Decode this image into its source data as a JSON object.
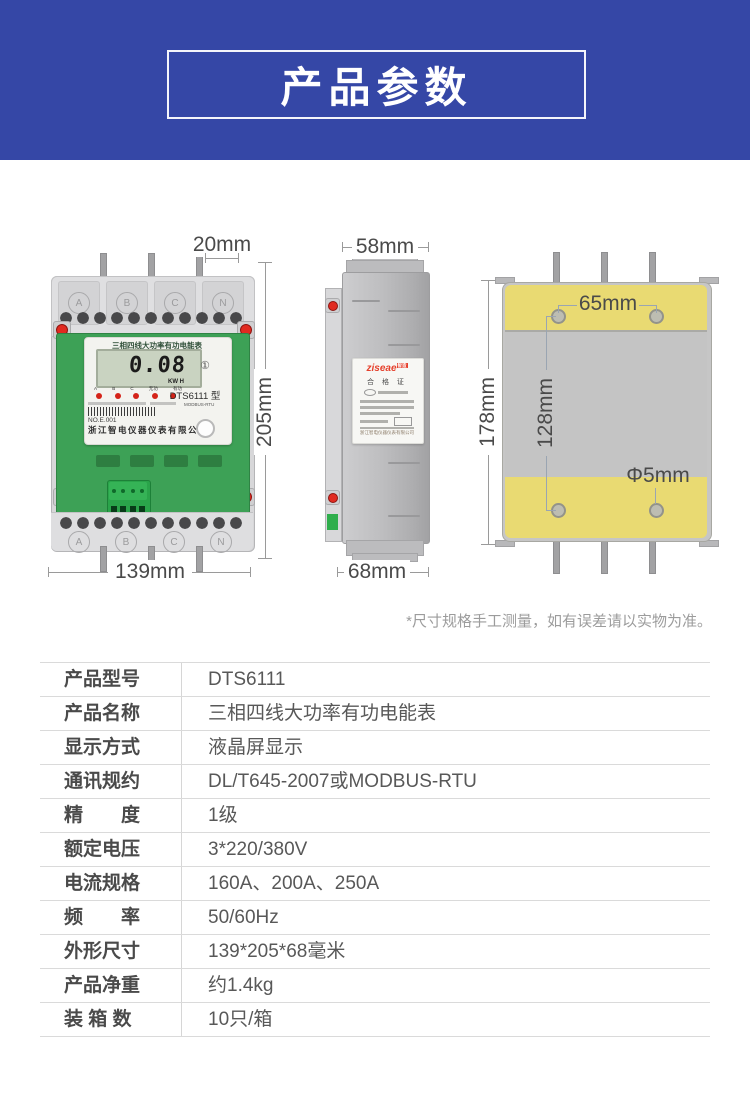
{
  "header": {
    "title": "产品参数"
  },
  "front_view": {
    "dim_top": "20mm",
    "dim_right": "205mm",
    "dim_bottom": "139mm",
    "terminals": [
      "A",
      "B",
      "C",
      "N"
    ],
    "label_title": "三相四线大功率有功电能表",
    "lcd_value": "0.08",
    "lcd_unit": "KW H",
    "lcd_badge": "①",
    "led_labels": [
      "A",
      "B",
      "C",
      "无功",
      "有功"
    ],
    "model": "DTS6111 型",
    "protocol": "MODBUS-RTU",
    "serial": "NO.E.001",
    "company": "浙江智电仪器仪表有限公司"
  },
  "side_view": {
    "dim_top": "58mm",
    "dim_bottom": "68mm",
    "logo": "ziseae",
    "logo_suffix": "智造",
    "cert_title": "合 格 证",
    "company": "浙江智电仪器仪表有限公司"
  },
  "back_view": {
    "dim_left": "178mm",
    "dim_holes_vertical": "128mm",
    "dim_holes_horizontal": "65mm",
    "dim_hole_diameter": "Φ5mm"
  },
  "note": "*尺寸规格手工测量，如有误差请以实物为准。",
  "spec_table": {
    "rows": [
      {
        "label": "产品型号",
        "value": "DTS6111"
      },
      {
        "label": "产品名称",
        "value": "三相四线大功率有功电能表"
      },
      {
        "label": "显示方式",
        "value": "液晶屏显示"
      },
      {
        "label": "通讯规约",
        "value": "DL/T645-2007或MODBUS-RTU"
      },
      {
        "label": "精　　度",
        "value": "1级"
      },
      {
        "label": "额定电压",
        "value": "3*220/380V"
      },
      {
        "label": "电流规格",
        "value": "160A、200A、250A"
      },
      {
        "label": "频　　率",
        "value": "50/60Hz"
      },
      {
        "label": "外形尺寸",
        "value": "139*205*68毫米"
      },
      {
        "label": "产品净重",
        "value": "约1.4kg"
      },
      {
        "label": "装 箱 数",
        "value": "10只/箱"
      }
    ]
  },
  "colors": {
    "header_blue": "#3547a6",
    "pcb_green": "#3da156",
    "plate_yellow": "#e9da72",
    "screw_red": "#e12a20",
    "logo_red": "#e5402c"
  }
}
